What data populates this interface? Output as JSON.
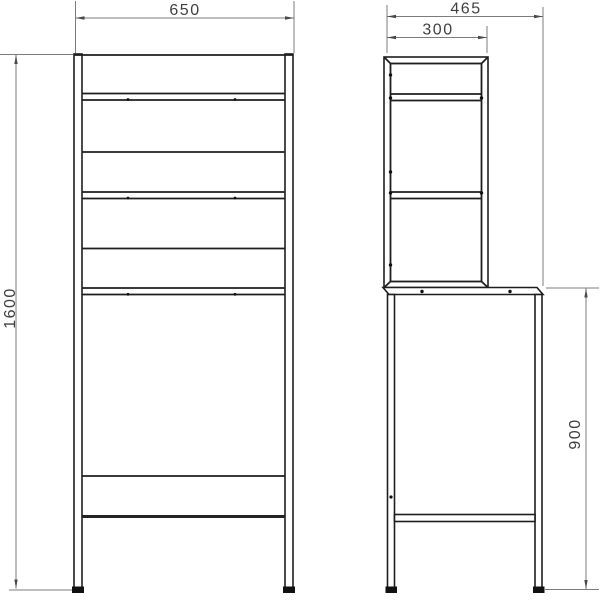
{
  "page": {
    "background": "#ffffff",
    "description": "Technical dimensional drawing of a shelving rack over washing machine: front view and side view"
  },
  "drawing": {
    "front_view": {
      "name": "front-view",
      "width_label": "650",
      "height_label": "1600"
    },
    "side_view": {
      "name": "side-view",
      "depth_label": "465",
      "shelf_depth_label": "300",
      "lower_height_label": "900"
    },
    "colors": {
      "object_line": "#1e1e1e",
      "dimension_line": "#7c7c7c",
      "arrow": "#4a4a4a",
      "label_text": "#3f3f3f",
      "background": "#ffffff"
    }
  }
}
